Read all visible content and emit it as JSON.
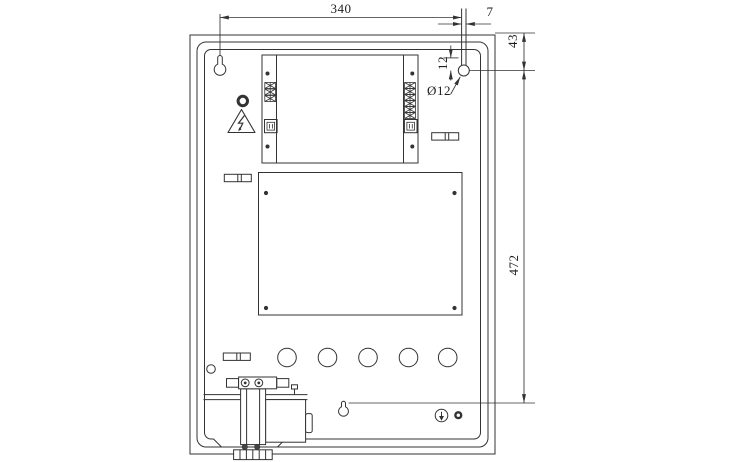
{
  "drawing": {
    "type": "technical-drawing",
    "subject": "meter box enclosure front view",
    "colors": {
      "line": "#333333",
      "background": "#ffffff"
    },
    "dimensions": {
      "top_width": "340",
      "slot_width": "7",
      "top_offset": "43",
      "slot_length": "12",
      "hole_diameter": "Ø12",
      "overall_height": "472"
    }
  }
}
